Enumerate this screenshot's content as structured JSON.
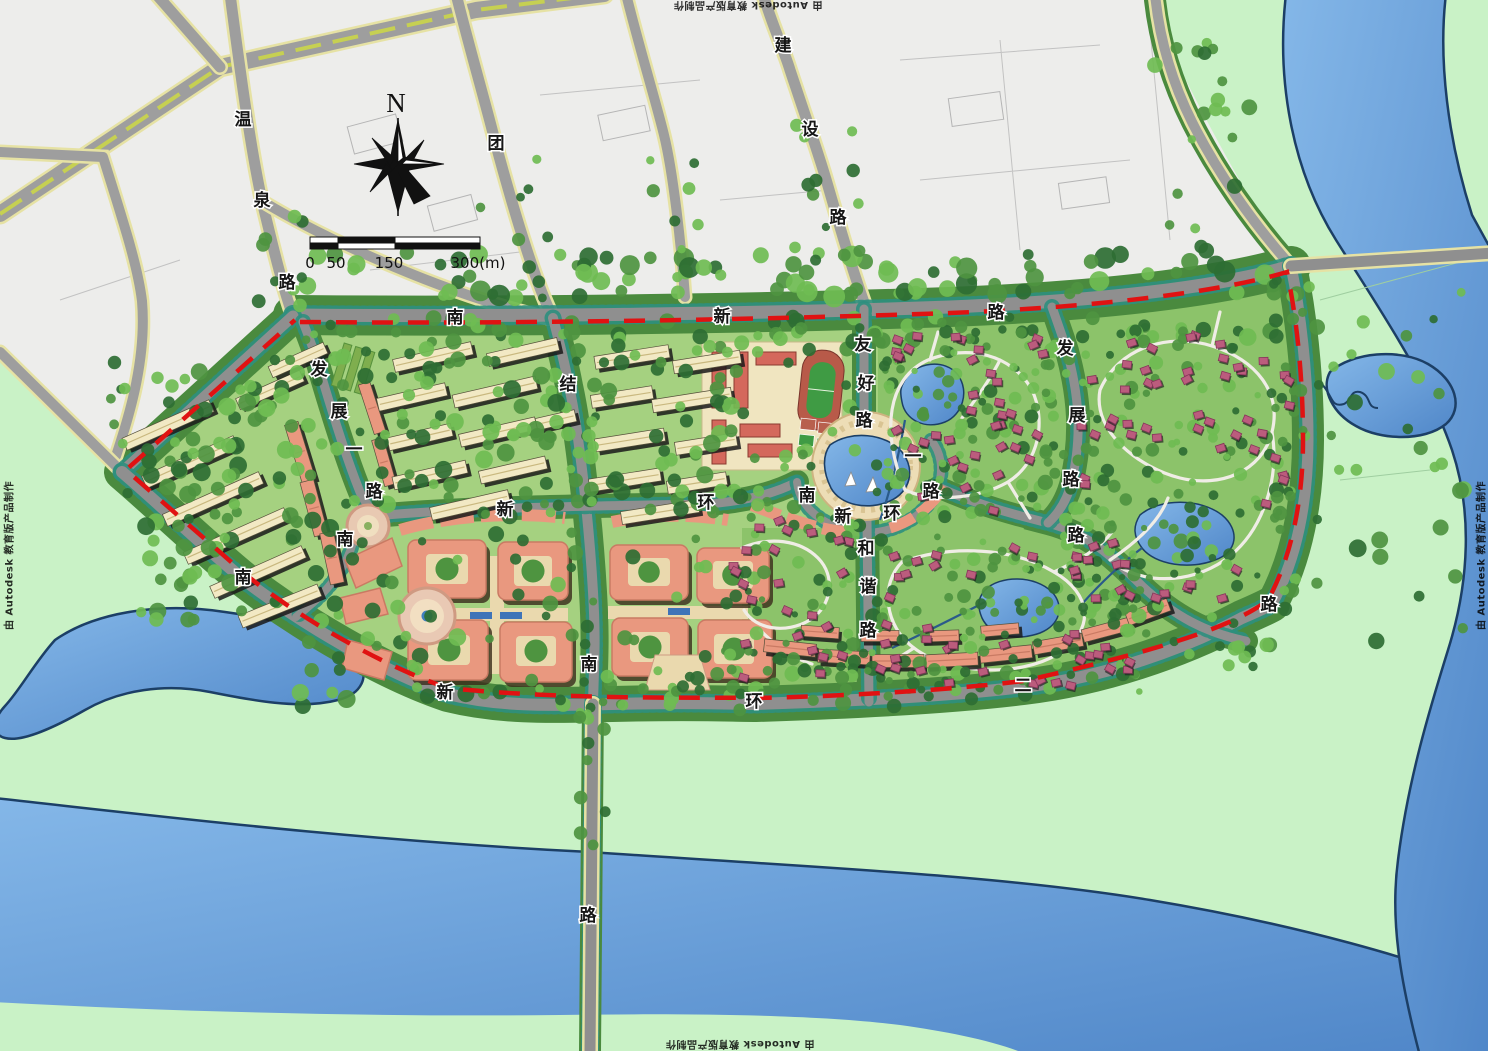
{
  "watermark": {
    "text": "由 Autodesk 教育版产品制作"
  },
  "compass": {
    "label": "N"
  },
  "scale_bar": {
    "ticks": [
      "0",
      "50",
      "150",
      "300(m)"
    ]
  },
  "palette": {
    "bank_green": "#c9f2c6",
    "city_white": "#ededeb",
    "road_gray": "#9e9e9e",
    "site_road_gray": "#8f8f8f",
    "road_casing_yellow": "#e6e2a4",
    "median_green": "#c6d052",
    "belt_green": "#4a8a3e",
    "lawn_green": "#a5d180",
    "villa_lawn_green": "#8cc36a",
    "tree_dark": "#2e6e33",
    "tree_mid": "#4e9440",
    "tree_light": "#6fbc52",
    "hedge_teal": "#2e8f7e",
    "water_light": "#7fb2e5",
    "water_mid": "#4f86c8",
    "water_outline": "#1c3f66",
    "boundary_red": "#e01212",
    "cream_building": "#f2e9c4",
    "pink_building": "#e9987f",
    "pink_building_dark": "#c97a63",
    "red_building": "#d4685c",
    "villa_pink": "#bb5c7d",
    "plaza_beige": "#ead9ae",
    "track_red": "#b85a49",
    "field_green": "#3f9b44"
  },
  "roads": [
    {
      "name": "温泉路",
      "chars": [
        {
          "c": "温",
          "x": 243,
          "y": 120
        },
        {
          "c": "泉",
          "x": 262,
          "y": 201
        },
        {
          "c": "路",
          "x": 287,
          "y": 283
        }
      ]
    },
    {
      "name": "团结南路",
      "chars": [
        {
          "c": "团",
          "x": 496,
          "y": 144
        },
        {
          "c": "结",
          "x": 568,
          "y": 385
        },
        {
          "c": "南",
          "x": 589,
          "y": 665
        },
        {
          "c": "路",
          "x": 588,
          "y": 916
        }
      ]
    },
    {
      "name": "建设路",
      "chars": [
        {
          "c": "建",
          "x": 783,
          "y": 46
        },
        {
          "c": "设",
          "x": 810,
          "y": 130
        },
        {
          "c": "路",
          "x": 838,
          "y": 218
        }
      ]
    },
    {
      "name": "南新路",
      "chars": [
        {
          "c": "南",
          "x": 455,
          "y": 318
        },
        {
          "c": "新",
          "x": 722,
          "y": 317
        },
        {
          "c": "路",
          "x": 996,
          "y": 313
        }
      ]
    },
    {
      "name": "发展一路",
      "chars": [
        {
          "c": "发",
          "x": 319,
          "y": 370
        },
        {
          "c": "展",
          "x": 339,
          "y": 412
        },
        {
          "c": "一",
          "x": 354,
          "y": 450
        },
        {
          "c": "路",
          "x": 374,
          "y": 492
        }
      ]
    },
    {
      "name": "友好路",
      "chars": [
        {
          "c": "友",
          "x": 863,
          "y": 345
        },
        {
          "c": "好",
          "x": 866,
          "y": 384
        },
        {
          "c": "路",
          "x": 864,
          "y": 421
        }
      ]
    },
    {
      "name": "南新环一路",
      "chars": [
        {
          "c": "南",
          "x": 345,
          "y": 540
        },
        {
          "c": "新",
          "x": 505,
          "y": 510
        },
        {
          "c": "环",
          "x": 706,
          "y": 503
        },
        {
          "c": "南",
          "x": 807,
          "y": 496
        },
        {
          "c": "新",
          "x": 843,
          "y": 517
        },
        {
          "c": "环",
          "x": 892,
          "y": 514
        },
        {
          "c": "一",
          "x": 913,
          "y": 457
        },
        {
          "c": "路",
          "x": 931,
          "y": 492
        },
        {
          "c": "路",
          "x": 1076,
          "y": 536
        }
      ]
    },
    {
      "name": "和谐路",
      "chars": [
        {
          "c": "和",
          "x": 866,
          "y": 549
        },
        {
          "c": "谐",
          "x": 868,
          "y": 587
        },
        {
          "c": "路",
          "x": 868,
          "y": 631
        }
      ]
    },
    {
      "name": "发展路",
      "chars": [
        {
          "c": "发",
          "x": 1065,
          "y": 349
        },
        {
          "c": "展",
          "x": 1077,
          "y": 416
        },
        {
          "c": "路",
          "x": 1071,
          "y": 480
        }
      ]
    },
    {
      "name": "南新环二路",
      "chars": [
        {
          "c": "南",
          "x": 243,
          "y": 578
        },
        {
          "c": "新",
          "x": 445,
          "y": 693
        },
        {
          "c": "环",
          "x": 754,
          "y": 702
        },
        {
          "c": "二",
          "x": 1023,
          "y": 686
        },
        {
          "c": "路",
          "x": 1269,
          "y": 605
        }
      ]
    }
  ]
}
